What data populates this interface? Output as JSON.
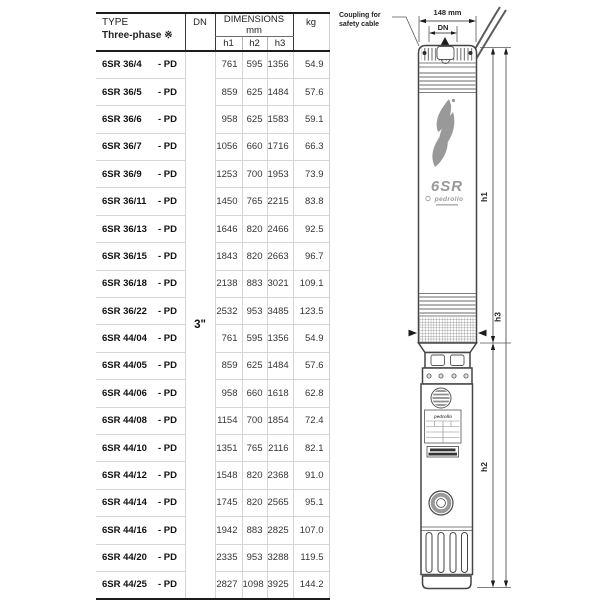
{
  "table": {
    "header": {
      "type_label": "TYPE",
      "type_sub_label": "Three-phase ※",
      "dn_label": "DN",
      "dimensions_label": "DIMENSIONS mm",
      "h1_label": "h1",
      "h2_label": "h2",
      "h3_label": "h3",
      "kg_label": "kg"
    },
    "dn_value": "3\"",
    "rows": [
      {
        "model": "6SR 36/4",
        "suffix": "- PD",
        "h1": "761",
        "h2": "595",
        "h3": "1356",
        "kg": "54.9"
      },
      {
        "model": "6SR 36/5",
        "suffix": "- PD",
        "h1": "859",
        "h2": "625",
        "h3": "1484",
        "kg": "57.6"
      },
      {
        "model": "6SR 36/6",
        "suffix": "- PD",
        "h1": "958",
        "h2": "625",
        "h3": "1583",
        "kg": "59.1"
      },
      {
        "model": "6SR 36/7",
        "suffix": "- PD",
        "h1": "1056",
        "h2": "660",
        "h3": "1716",
        "kg": "66.3"
      },
      {
        "model": "6SR 36/9",
        "suffix": "- PD",
        "h1": "1253",
        "h2": "700",
        "h3": "1953",
        "kg": "73.9"
      },
      {
        "model": "6SR 36/11",
        "suffix": "- PD",
        "h1": "1450",
        "h2": "765",
        "h3": "2215",
        "kg": "83.8"
      },
      {
        "model": "6SR 36/13",
        "suffix": "- PD",
        "h1": "1646",
        "h2": "820",
        "h3": "2466",
        "kg": "92.5"
      },
      {
        "model": "6SR 36/15",
        "suffix": "- PD",
        "h1": "1843",
        "h2": "820",
        "h3": "2663",
        "kg": "96.7"
      },
      {
        "model": "6SR 36/18",
        "suffix": "- PD",
        "h1": "2138",
        "h2": "883",
        "h3": "3021",
        "kg": "109.1"
      },
      {
        "model": "6SR 36/22",
        "suffix": "- PD",
        "h1": "2532",
        "h2": "953",
        "h3": "3485",
        "kg": "123.5"
      },
      {
        "model": "6SR 44/04",
        "suffix": "- PD",
        "h1": "761",
        "h2": "595",
        "h3": "1356",
        "kg": "54.9"
      },
      {
        "model": "6SR 44/05",
        "suffix": "- PD",
        "h1": "859",
        "h2": "625",
        "h3": "1484",
        "kg": "57.6"
      },
      {
        "model": "6SR 44/06",
        "suffix": "- PD",
        "h1": "958",
        "h2": "660",
        "h3": "1618",
        "kg": "62.8"
      },
      {
        "model": "6SR 44/08",
        "suffix": "- PD",
        "h1": "1154",
        "h2": "700",
        "h3": "1854",
        "kg": "72.4"
      },
      {
        "model": "6SR 44/10",
        "suffix": "- PD",
        "h1": "1351",
        "h2": "765",
        "h3": "2116",
        "kg": "82.1"
      },
      {
        "model": "6SR 44/12",
        "suffix": "- PD",
        "h1": "1548",
        "h2": "820",
        "h3": "2368",
        "kg": "91.0"
      },
      {
        "model": "6SR 44/14",
        "suffix": "- PD",
        "h1": "1745",
        "h2": "820",
        "h3": "2565",
        "kg": "95.1"
      },
      {
        "model": "6SR 44/16",
        "suffix": "- PD",
        "h1": "1942",
        "h2": "883",
        "h3": "2825",
        "kg": "107.0"
      },
      {
        "model": "6SR 44/20",
        "suffix": "- PD",
        "h1": "2335",
        "h2": "953",
        "h3": "3288",
        "kg": "119.5"
      },
      {
        "model": "6SR 44/25",
        "suffix": "- PD",
        "h1": "2827",
        "h2": "1098",
        "h3": "3925",
        "kg": "144.2"
      }
    ]
  },
  "drawing": {
    "width_dim_label": "148 mm",
    "dn_dim_label": "DN",
    "coupling_note_line1": "Coupling for",
    "coupling_note_line2": "safety cable",
    "h1_label": "h1",
    "h2_label": "h2",
    "h3_label": "h3",
    "branding": {
      "model_logo": "6SR",
      "brand": "pedrollo",
      "plate_brand": "pedrollo",
      "logo_color": "#999999"
    }
  }
}
